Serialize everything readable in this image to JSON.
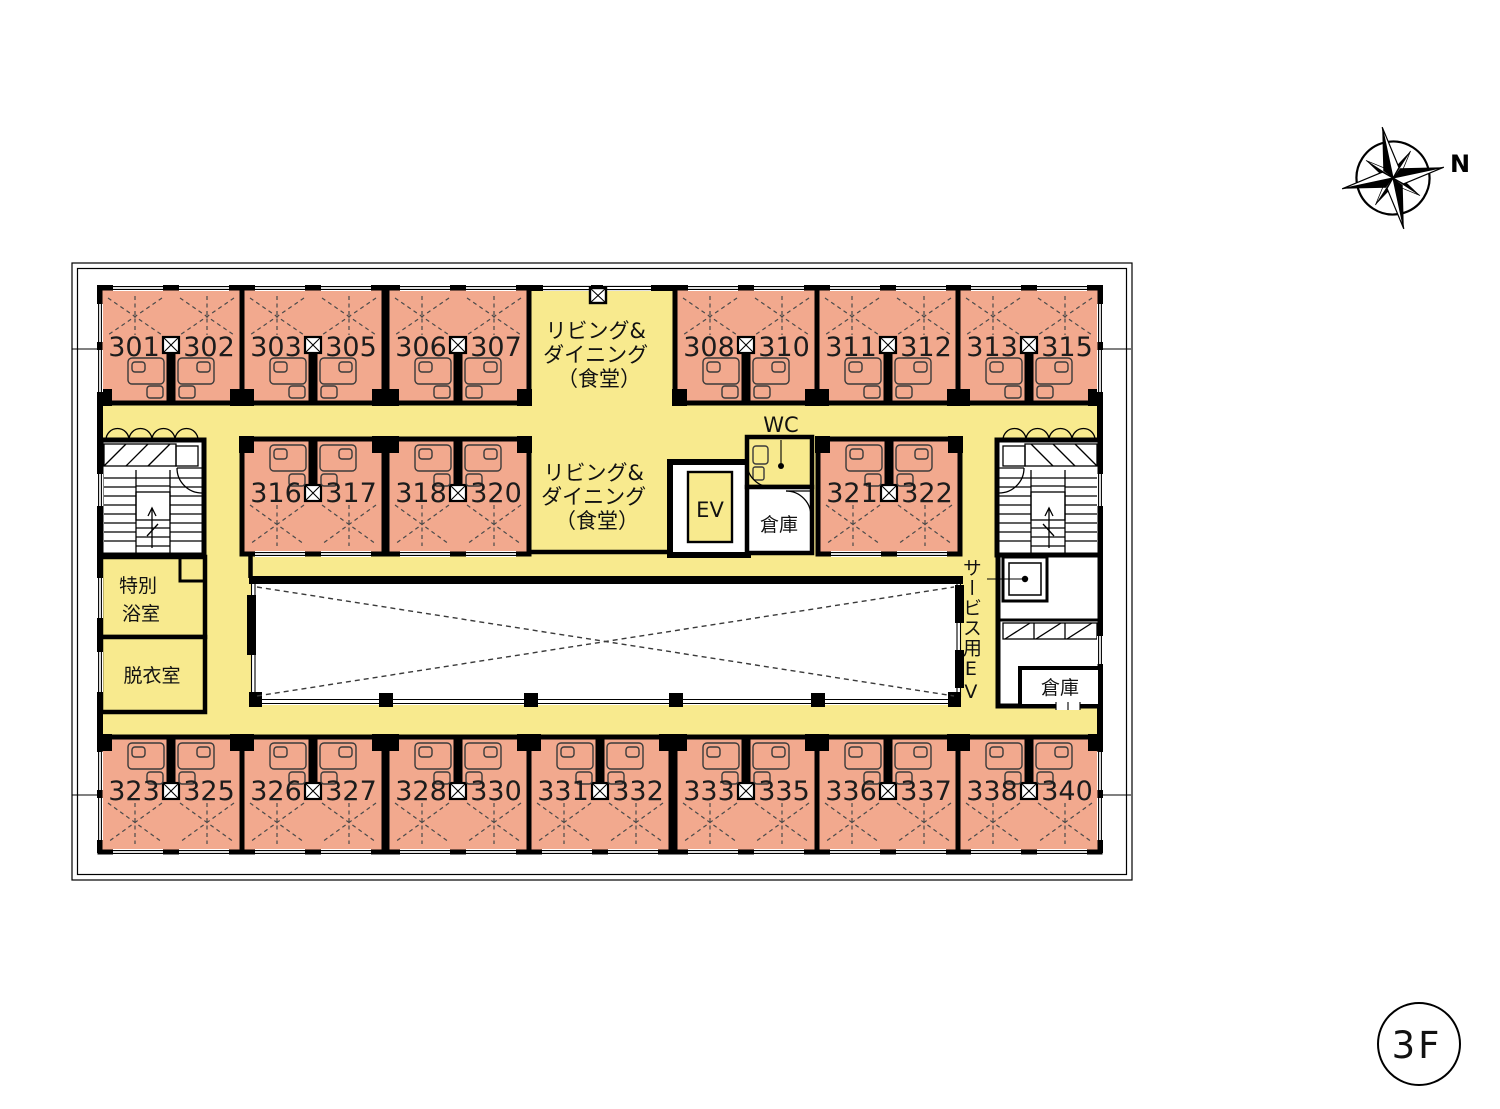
{
  "floor": {
    "badge": "3F"
  },
  "compass": {
    "north": "N"
  },
  "areas": {
    "living_dining": {
      "line1": "リビング&",
      "line2": "ダイニング",
      "line3": "（食堂）"
    },
    "wc": "WC",
    "elevator": "EV",
    "storage_center": "倉庫",
    "storage_right": "倉庫",
    "special_bath": {
      "line1": "特別",
      "line2": "浴室"
    },
    "dressing_room": "脱衣室",
    "service_elevator": {
      "jp": "サービス用",
      "en": "EV"
    }
  },
  "rooms": {
    "top": [
      {
        "left": "301",
        "right": "302"
      },
      {
        "left": "303",
        "right": "305"
      },
      {
        "left": "306",
        "right": "307"
      },
      {
        "left": "308",
        "right": "310"
      },
      {
        "left": "311",
        "right": "312"
      },
      {
        "left": "313",
        "right": "315"
      }
    ],
    "middle": [
      {
        "left": "316",
        "right": "317"
      },
      {
        "left": "318",
        "right": "320"
      },
      {
        "left": "321",
        "right": "322"
      }
    ],
    "bottom": [
      {
        "left": "323",
        "right": "325"
      },
      {
        "left": "326",
        "right": "327"
      },
      {
        "left": "328",
        "right": "330"
      },
      {
        "left": "331",
        "right": "332"
      },
      {
        "left": "333",
        "right": "335"
      },
      {
        "left": "336",
        "right": "337"
      },
      {
        "left": "338",
        "right": "340"
      }
    ]
  },
  "colors": {
    "room_fill": "#F2A98E",
    "corridor_fill": "#F8EA8E",
    "wall": "#000000",
    "background": "#FFFFFF"
  }
}
